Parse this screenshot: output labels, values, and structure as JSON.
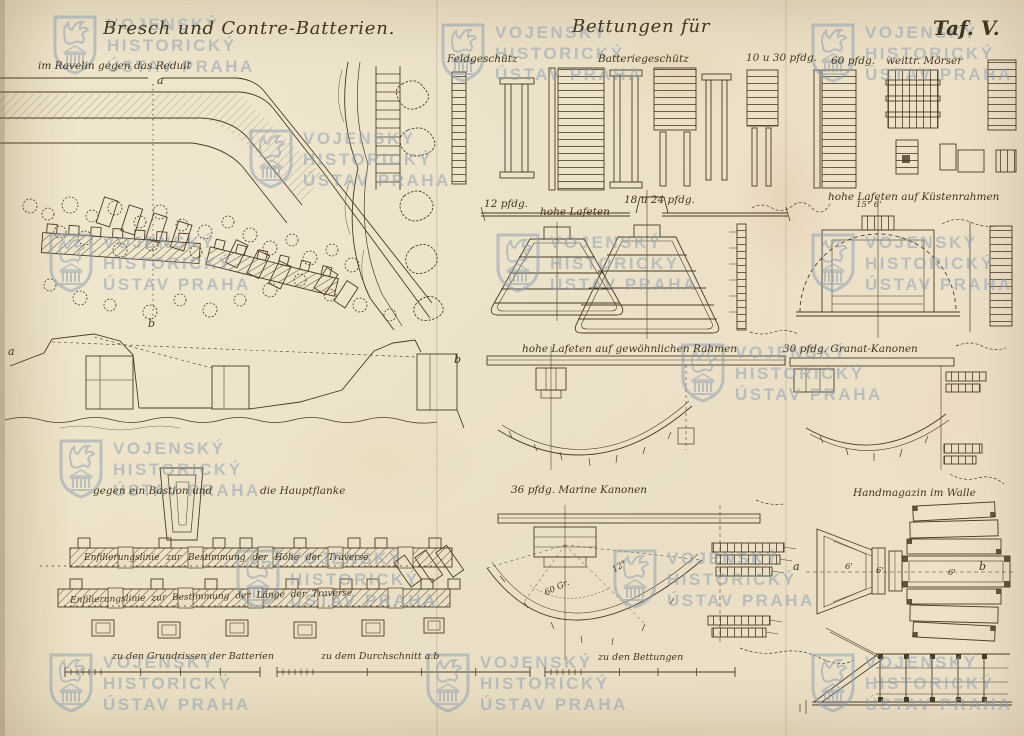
{
  "plate": {
    "title_left": "Bresch und Contre-Batterien.",
    "title_center": "Bettungen für",
    "plate_number": "Taf. V."
  },
  "watermark": {
    "line1": "VOJENSKÝ",
    "line2": "HISTORICKÝ",
    "line3": "ÚSTAV PRAHA",
    "color": "#8fa0b0"
  },
  "sections": {
    "ravelin_label": "im Ravelin gegen das Reduit",
    "bastion_label": "gegen ein Bastion und",
    "hauptflanke_label": "die Hauptflanke"
  },
  "bettungen_labels": {
    "feldgeschuetz": "Feldgeschütz",
    "batteriegeschuetz": "Batteriegeschütz",
    "pfdg_10_30": "10 u 30 pfdg.",
    "pfdg_60": "60 pfdg.",
    "moerser": "weittr. Mörser",
    "pfdg_12": "12 pfdg.",
    "hohe_lafeten": "hohe Lafeten",
    "pfdg_18_24": "18 u 24 pfdg.",
    "kuestenrahmen": "hohe Lafeten auf Küstenrahmen",
    "gewoehnlich": "hohe Lafeten auf gewöhnlichen Rahmen",
    "granat": "30 pfdg. Granat-Kanonen",
    "marine": "36 pfdg. Marine Kanonen",
    "handmagazin": "Handmagazin im Walle"
  },
  "enfilade": {
    "hoehe": "Enfilierungslinie zur Bestimmung der Höhe der Traverse",
    "laenge": "Enfilierungslinie zur Bestimmung der Länge der Traverse"
  },
  "scale_labels": {
    "grundrisse": "zu den Grundrissen der Batterien",
    "durchschnitt": "zu dem Durchschnitt a.b",
    "bettungen": "zu den Bettungen"
  },
  "markers": {
    "a": "a",
    "b": "b"
  },
  "annotations": {
    "deg_15_6": "15° 6'",
    "deg_60": "60 Gr.",
    "deg_12": "12°",
    "six_feet": "6'"
  },
  "colors": {
    "paper": "#eadfc5",
    "ink": "#493b26",
    "watermark": "#8fa0b0"
  }
}
